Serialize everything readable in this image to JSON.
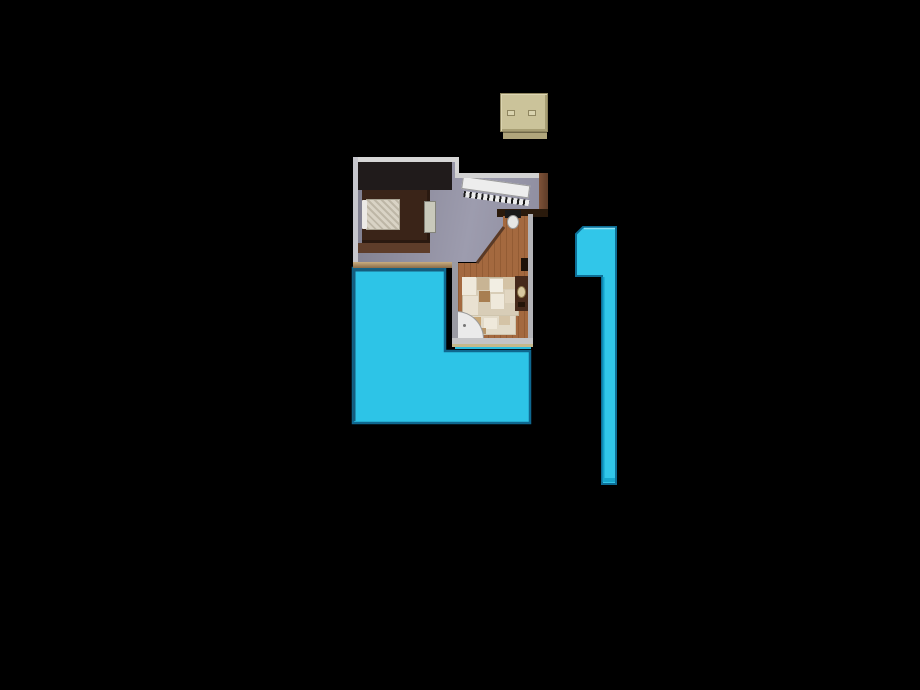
{
  "scene": {
    "background": "#000000",
    "description_colors": {
      "pool_cyan": "#2dc4e7",
      "pool_edge_dark": "#0f6890",
      "floor_gray": "#908fa0",
      "wood_wall_brown": "#6e4833",
      "bathroom_terracotta": "#a4693f",
      "tile_beige": "#d8cdb7",
      "box_tan": "#cbc39a",
      "wall_white": "#d6d6d6"
    },
    "objects": [
      {
        "name": "pool-water",
        "interactable": false,
        "type": "polygon",
        "points": "353,268 445,268 445,351 530,351 530,423 353,423",
        "fill": "#2dc4e7",
        "stroke": "#0f6890",
        "strokeWidth": 2.5
      },
      {
        "name": "pool-edge-bevel",
        "interactable": false,
        "type": "polyline",
        "points": "354,421 354,270 444,270",
        "fill": "none",
        "stroke": "#155d7d",
        "strokeWidth": 3
      },
      {
        "name": "pool-sliver",
        "interactable": false,
        "type": "div",
        "style": {
          "left": "455px",
          "top": "345px",
          "width": "76px",
          "height": "4px",
          "background": "#2bbde0"
        }
      },
      {
        "name": "bedroom-floor",
        "interactable": false,
        "type": "div",
        "style": {
          "left": "353px",
          "top": "157px",
          "width": "195px",
          "height": "110px",
          "background": "linear-gradient(100deg,#7f7e8e 0%,#9d9cae 60%,#8c8b9d 100%)",
          "clipPath": "polygon(5px 5px,102px 5px,102px 21px,186px 21px,186px 53px,150px 53px,150px 70px,124px 105px,5px 105px)"
        }
      },
      {
        "name": "bedroom-dark-corner",
        "interactable": false,
        "type": "div",
        "style": {
          "left": "358px",
          "top": "162px",
          "width": "94px",
          "height": "28px",
          "background": "#201b1b"
        }
      },
      {
        "name": "bed-platform",
        "interactable": false,
        "type": "div",
        "style": {
          "left": "362px",
          "top": "190px",
          "width": "68px",
          "height": "53px",
          "background": "#3a2418",
          "boxShadow": "inset -3px 0 0 #2a1910, inset 0 -3px 0 #2a1910"
        }
      },
      {
        "name": "bed-frame-band",
        "interactable": false,
        "type": "div",
        "style": {
          "left": "356px",
          "top": "243px",
          "width": "74px",
          "height": "10px",
          "background": "#5e3d2a"
        }
      },
      {
        "name": "bed-quilt",
        "interactable": false,
        "type": "div",
        "style": {
          "left": "366px",
          "top": "199px",
          "width": "34px",
          "height": "31px",
          "background": "#d9d3c5",
          "backgroundImage": "repeating-linear-gradient(45deg,rgba(120,110,90,0.28) 0 2px,transparent 2px 5px)",
          "border": "1px solid #a8a292"
        }
      },
      {
        "name": "bed-pillow",
        "interactable": false,
        "type": "div",
        "style": {
          "left": "362px",
          "top": "200px",
          "width": "5px",
          "height": "29px",
          "background": "#eceae6",
          "borderRadius": "1px"
        }
      },
      {
        "name": "dresser",
        "interactable": false,
        "type": "div",
        "style": {
          "left": "424px",
          "top": "201px",
          "width": "12px",
          "height": "32px",
          "background": "#c9c9bb",
          "border": "1px solid #83837a"
        }
      },
      {
        "name": "staircase-deck",
        "interactable": false,
        "type": "div",
        "style": {
          "left": "463px",
          "top": "176px",
          "width": "68px",
          "height": "13px",
          "background": "#ededed",
          "border": "1px solid #9a9a9a",
          "transform": "rotate(8deg)",
          "transformOrigin": "0 0"
        }
      },
      {
        "name": "staircase-balusters",
        "interactable": false,
        "type": "div",
        "style": {
          "left": "464px",
          "top": "191px",
          "width": "66px",
          "height": "6px",
          "background": "repeating-linear-gradient(90deg,#1a1a1a 0 2px,#ececec 2px 6px)",
          "transform": "rotate(8deg)",
          "transformOrigin": "0 0"
        }
      },
      {
        "name": "top-wall-left",
        "interactable": false,
        "type": "div",
        "style": {
          "left": "353px",
          "top": "157px",
          "width": "106px",
          "height": "5px",
          "background": "#d6d6d6"
        }
      },
      {
        "name": "left-wall",
        "interactable": false,
        "type": "div",
        "style": {
          "left": "353px",
          "top": "157px",
          "width": "5px",
          "height": "110px",
          "background": "#c6c6cc"
        }
      },
      {
        "name": "step-wall",
        "interactable": false,
        "type": "div",
        "style": {
          "left": "455px",
          "top": "157px",
          "width": "4px",
          "height": "21px",
          "background": "#d6d6d6"
        }
      },
      {
        "name": "top-wall-right",
        "interactable": false,
        "type": "div",
        "style": {
          "left": "455px",
          "top": "173px",
          "width": "88px",
          "height": "5px",
          "background": "#d2d2d2"
        }
      },
      {
        "name": "right-wall-wood",
        "interactable": false,
        "type": "div",
        "style": {
          "left": "539px",
          "top": "173px",
          "width": "9px",
          "height": "43px",
          "background": "linear-gradient(90deg,#7e5238,#5e3c28)"
        }
      },
      {
        "name": "bedroom-bottom-wall",
        "interactable": false,
        "type": "div",
        "style": {
          "left": "353px",
          "top": "262px",
          "width": "102px",
          "height": "6px",
          "background": "linear-gradient(#c9ad80,#8a6b48)"
        }
      },
      {
        "name": "alcove-top-wall",
        "interactable": false,
        "type": "div",
        "style": {
          "left": "497px",
          "top": "209px",
          "width": "51px",
          "height": "8px",
          "background": "#2a1a0c"
        }
      },
      {
        "name": "bathroom-floor",
        "interactable": false,
        "type": "div",
        "style": {
          "left": "452px",
          "top": "216px",
          "width": "81px",
          "height": "126px",
          "background": "#a4693f",
          "backgroundImage": "repeating-linear-gradient(90deg,rgba(70,30,5,0.18) 0 1px,transparent 1px 6px)",
          "clipPath": "polygon(51px 0px,76px 0px,76px 126px,6px 126px,6px 47px,26px 47px,51px 12px)"
        }
      },
      {
        "name": "hallway-diagonal-wall",
        "interactable": false,
        "type": "polyline",
        "points": "477,263 504,227",
        "fill": "none",
        "stroke": "#5a3a26",
        "strokeWidth": 3
      },
      {
        "name": "toilet-tank",
        "interactable": false,
        "type": "div",
        "style": {
          "left": "505px",
          "top": "210px",
          "width": "16px",
          "height": "8px",
          "background": "#191919"
        }
      },
      {
        "name": "toilet-bowl",
        "interactable": false,
        "type": "div",
        "style": {
          "left": "507px",
          "top": "215px",
          "width": "12px",
          "height": "14px",
          "background": "#e6e6e4",
          "border": "1px solid #9a9a9a",
          "borderRadius": "50%"
        }
      },
      {
        "name": "hallway-item",
        "interactable": false,
        "type": "div",
        "style": {
          "left": "521px",
          "top": "258px",
          "width": "7px",
          "height": "13px",
          "background": "#1d1107"
        }
      },
      {
        "name": "tile-rug",
        "interactable": false,
        "type": "div",
        "style": {
          "left": "462px",
          "top": "277px",
          "width": "57px",
          "height": "39px",
          "background": "#d8cdb7",
          "border": "1px solid #c2b69c"
        }
      },
      {
        "name": "tile-patch",
        "interactable": false,
        "type": "div",
        "style": {
          "left": "462px",
          "top": "277px",
          "width": "14px",
          "height": "18px",
          "background": "#efe9db"
        }
      },
      {
        "name": "tile-patch",
        "interactable": false,
        "type": "div",
        "style": {
          "left": "477px",
          "top": "278px",
          "width": "12px",
          "height": "12px",
          "background": "#c8b494"
        }
      },
      {
        "name": "tile-patch",
        "interactable": false,
        "type": "div",
        "style": {
          "left": "490px",
          "top": "279px",
          "width": "13px",
          "height": "13px",
          "background": "#f2eee3"
        }
      },
      {
        "name": "tile-patch",
        "interactable": false,
        "type": "div",
        "style": {
          "left": "503px",
          "top": "277px",
          "width": "15px",
          "height": "12px",
          "background": "#d4c3a6"
        }
      },
      {
        "name": "tile-patch",
        "interactable": false,
        "type": "div",
        "style": {
          "left": "463px",
          "top": "296px",
          "width": "15px",
          "height": "19px",
          "background": "#e9e1d1"
        }
      },
      {
        "name": "tile-patch",
        "interactable": false,
        "type": "div",
        "style": {
          "left": "479px",
          "top": "291px",
          "width": "11px",
          "height": "11px",
          "background": "#a87e51"
        }
      },
      {
        "name": "tile-patch",
        "interactable": false,
        "type": "div",
        "style": {
          "left": "491px",
          "top": "294px",
          "width": "13px",
          "height": "15px",
          "background": "#efe9db"
        }
      },
      {
        "name": "tile-patch",
        "interactable": false,
        "type": "div",
        "style": {
          "left": "505px",
          "top": "290px",
          "width": "13px",
          "height": "13px",
          "background": "#e1d6c1"
        }
      },
      {
        "name": "tile-rug-lower",
        "interactable": false,
        "type": "div",
        "style": {
          "left": "466px",
          "top": "315px",
          "width": "50px",
          "height": "20px",
          "background": "#e2dac8",
          "border": "1px solid #cfc5ae"
        }
      },
      {
        "name": "tile-patch",
        "interactable": false,
        "type": "div",
        "style": {
          "left": "470px",
          "top": "317px",
          "width": "11px",
          "height": "9px",
          "background": "#c7a777"
        }
      },
      {
        "name": "tile-patch",
        "interactable": false,
        "type": "div",
        "style": {
          "left": "484px",
          "top": "318px",
          "width": "13px",
          "height": "11px",
          "background": "#efe9db"
        }
      },
      {
        "name": "tile-patch",
        "interactable": false,
        "type": "div",
        "style": {
          "left": "499px",
          "top": "316px",
          "width": "11px",
          "height": "9px",
          "background": "#d4c3a6"
        }
      },
      {
        "name": "tile-patch",
        "interactable": false,
        "type": "div",
        "style": {
          "left": "477px",
          "top": "328px",
          "width": "9px",
          "height": "6px",
          "background": "#b8966a"
        }
      },
      {
        "name": "shower-pan",
        "interactable": false,
        "type": "div",
        "style": {
          "left": "456px",
          "top": "311px",
          "width": "28px",
          "height": "28px",
          "background": "#eaeaea",
          "border": "1px solid #9a9a9a",
          "borderTopRightRadius": "100%"
        }
      },
      {
        "name": "shower-drain",
        "interactable": false,
        "type": "div",
        "style": {
          "left": "463px",
          "top": "324px",
          "width": "3px",
          "height": "3px",
          "background": "#767676",
          "borderRadius": "50%"
        }
      },
      {
        "name": "vanity",
        "interactable": false,
        "type": "div",
        "style": {
          "left": "515px",
          "top": "276px",
          "width": "13px",
          "height": "35px",
          "background": "#46291a"
        }
      },
      {
        "name": "vanity-sink",
        "interactable": false,
        "type": "div",
        "style": {
          "left": "517px",
          "top": "286px",
          "width": "9px",
          "height": "12px",
          "background": "#d9c9a1",
          "border": "1px solid #8a7448",
          "borderRadius": "50%"
        }
      },
      {
        "name": "vanity-item",
        "interactable": false,
        "type": "div",
        "style": {
          "left": "518px",
          "top": "302px",
          "width": "7px",
          "height": "5px",
          "background": "#241408"
        }
      },
      {
        "name": "bathroom-left-wall",
        "interactable": false,
        "type": "div",
        "style": {
          "left": "452px",
          "top": "262px",
          "width": "6px",
          "height": "84px",
          "background": "#9a9aa2"
        }
      },
      {
        "name": "bathroom-right-wall",
        "interactable": false,
        "type": "div",
        "style": {
          "left": "528px",
          "top": "214px",
          "width": "5px",
          "height": "132px",
          "background": "#b4b4b8"
        }
      },
      {
        "name": "bathroom-bottom-wall",
        "interactable": false,
        "type": "div",
        "style": {
          "left": "452px",
          "top": "338px",
          "width": "81px",
          "height": "6px",
          "background": "#c4c4c6"
        }
      },
      {
        "name": "bathroom-bottom-trim",
        "interactable": false,
        "type": "div",
        "style": {
          "left": "452px",
          "top": "344px",
          "width": "81px",
          "height": "3px",
          "background": "#c6b98b"
        }
      },
      {
        "name": "lap-pool-body",
        "interactable": false,
        "type": "path",
        "d": "M576,234 L583,227 L616,227 L616,484 L602,484 L602,276 L576,276 Z",
        "fill": "#31c6e9",
        "stroke": "#0d6e96",
        "strokeWidth": 2
      },
      {
        "name": "lap-pool-strip-edge",
        "interactable": false,
        "type": "polyline",
        "points": "603.5,277 603.5,482",
        "fill": "none",
        "stroke": "#14a2cb",
        "strokeWidth": 2
      },
      {
        "name": "lap-pool-top-highlight",
        "interactable": false,
        "type": "polyline",
        "points": "584,228.5 615,228.5",
        "fill": "none",
        "stroke": "#8ae2f5",
        "strokeWidth": 1.5
      },
      {
        "name": "lap-pool-bottom-bevel",
        "interactable": false,
        "type": "polyline",
        "points": "603,480 615,480",
        "fill": "none",
        "stroke": "#18a6cc",
        "strokeWidth": 4
      },
      {
        "name": "storage-box-body",
        "interactable": false,
        "type": "div",
        "style": {
          "left": "500px",
          "top": "93px",
          "width": "48px",
          "height": "39px",
          "background": "#cbc39a",
          "border": "1px solid #8f8660",
          "boxShadow": "inset 1px 1px 0 #dcd5b2, inset -2px -2px 0 #a79e74"
        }
      },
      {
        "name": "storage-box-base",
        "interactable": false,
        "type": "div",
        "style": {
          "left": "503px",
          "top": "132px",
          "width": "44px",
          "height": "7px",
          "background": "#b1a67c",
          "borderTop": "1px solid #6e6647"
        }
      },
      {
        "name": "storage-box-handle",
        "interactable": false,
        "type": "div",
        "style": {
          "left": "507px",
          "top": "110px",
          "width": "8px",
          "height": "6px",
          "background": "#d9d3af",
          "border": "1px solid #8f8660"
        }
      },
      {
        "name": "storage-box-handle",
        "interactable": false,
        "type": "div",
        "style": {
          "left": "528px",
          "top": "110px",
          "width": "8px",
          "height": "6px",
          "background": "#d9d3af",
          "border": "1px solid #8f8660"
        }
      }
    ]
  }
}
